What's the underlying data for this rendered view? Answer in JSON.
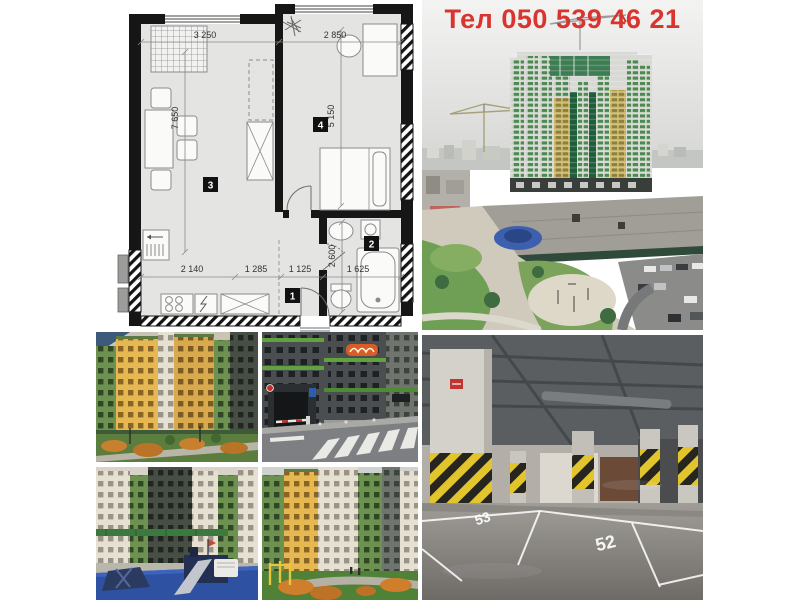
{
  "contact": {
    "phone": "Тел 050 539 46 21"
  },
  "floor_plan": {
    "dims": {
      "top_left": "3 250",
      "top_right": "2 850",
      "left_height": "7 650",
      "bedroom_height": "5 150",
      "bath_height": "2 600",
      "bottom": [
        "2 140",
        "1 285",
        "1 125",
        "1 625"
      ]
    },
    "room_badges": {
      "hall": "1",
      "bath": "2",
      "living": "3",
      "bedroom": "4"
    }
  },
  "parking": {
    "space_numbers": [
      "53",
      "52"
    ]
  },
  "colors": {
    "phone_red": "#d9342f",
    "hazard_yellow": "#e2c52c",
    "plan_wall": "#161616",
    "facade_green": "#6d9150",
    "facade_yellow": "#d9a94e"
  }
}
